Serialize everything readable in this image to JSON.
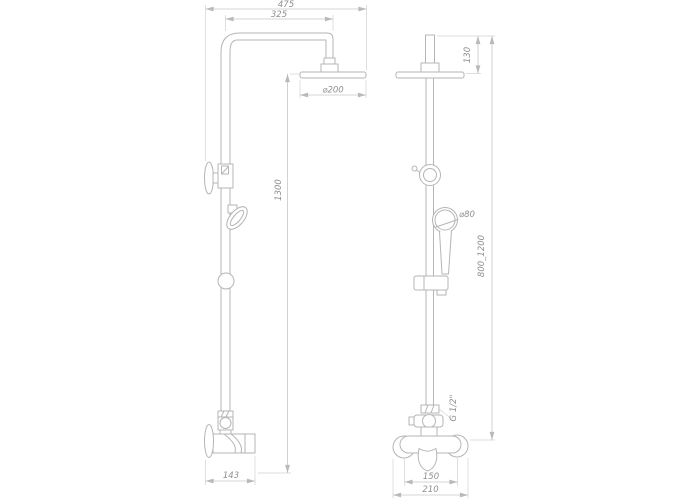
{
  "drawing": {
    "type": "technical-dimension-drawing",
    "subject": "shower-system-with-overhead-and-hand-shower",
    "colors": {
      "background": "#ffffff",
      "part_line": "#b5b5b5",
      "dimension_line": "#c7c7c7",
      "text": "#8f8f8f"
    },
    "side_view": {
      "dim_overall_width": "475",
      "dim_arm_reach": "325",
      "dim_head_diameter": "⌀200",
      "dim_column_height": "1300",
      "dim_mixer_depth": "143"
    },
    "front_view": {
      "dim_head_offset": "130",
      "dim_handshower_diameter": "⌀80",
      "dim_adjustable_height": "800_1200",
      "dim_thread": "G 1/2\"",
      "dim_connection_centers": "150",
      "dim_mixer_width": "210"
    }
  }
}
